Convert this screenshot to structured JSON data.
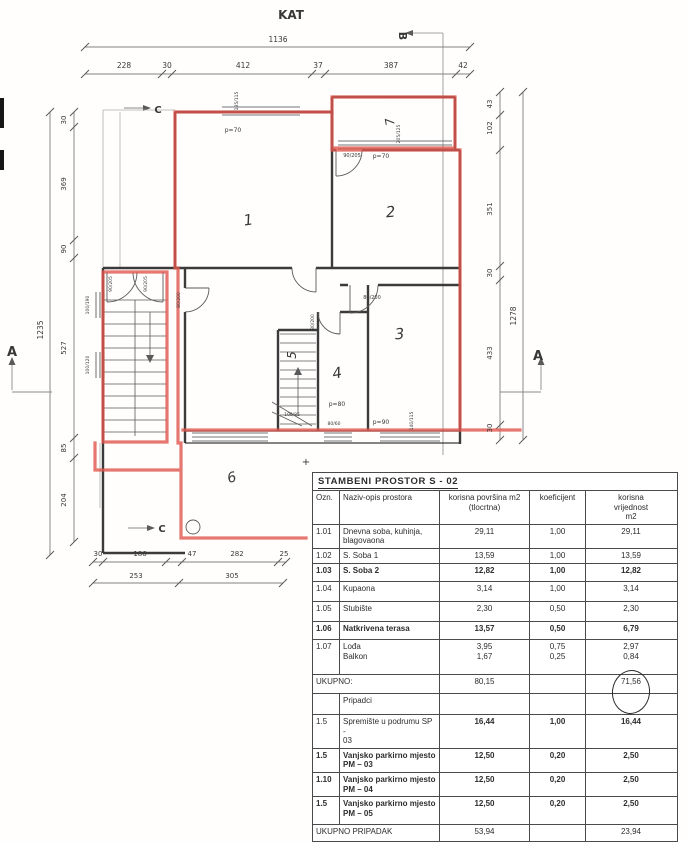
{
  "plan": {
    "ink": "#383838",
    "red": "#e0564e",
    "texts": [
      {
        "t": "KAT",
        "x": 291,
        "y": 19,
        "s": 12,
        "w": 1,
        "n": "plan-title"
      },
      {
        "t": "1136",
        "x": 278,
        "y": 42,
        "s": 7.5,
        "n": "dim-top-total"
      },
      {
        "t": "228",
        "x": 124,
        "y": 68,
        "s": 7.5,
        "n": "dim-top"
      },
      {
        "t": "30",
        "x": 167,
        "y": 68,
        "s": 7.5,
        "n": "dim-top"
      },
      {
        "t": "412",
        "x": 243,
        "y": 68,
        "s": 7.5,
        "n": "dim-top"
      },
      {
        "t": "37",
        "x": 318,
        "y": 68,
        "s": 7.5,
        "n": "dim-top"
      },
      {
        "t": "387",
        "x": 391,
        "y": 68,
        "s": 7.5,
        "n": "dim-top"
      },
      {
        "t": "42",
        "x": 463,
        "y": 68,
        "s": 7.5,
        "n": "dim-top"
      },
      {
        "t": "30",
        "x": 66,
        "y": 120,
        "s": 7,
        "r": -90,
        "n": "dim-left"
      },
      {
        "t": "369",
        "x": 66,
        "y": 184,
        "s": 7,
        "r": -90,
        "n": "dim-left"
      },
      {
        "t": "90",
        "x": 66,
        "y": 249,
        "s": 7,
        "r": -90,
        "n": "dim-left"
      },
      {
        "t": "527",
        "x": 66,
        "y": 348,
        "s": 7,
        "r": -90,
        "n": "dim-left"
      },
      {
        "t": "85",
        "x": 66,
        "y": 448,
        "s": 7,
        "r": -90,
        "n": "dim-left"
      },
      {
        "t": "204",
        "x": 66,
        "y": 500,
        "s": 7,
        "r": -90,
        "n": "dim-left"
      },
      {
        "t": "1235",
        "x": 43,
        "y": 330,
        "s": 7.5,
        "r": -90,
        "n": "dim-left-total"
      },
      {
        "t": "43",
        "x": 492,
        "y": 104,
        "s": 7,
        "r": -90,
        "n": "dim-right"
      },
      {
        "t": "102",
        "x": 492,
        "y": 128,
        "s": 7,
        "r": -90,
        "n": "dim-right"
      },
      {
        "t": "351",
        "x": 492,
        "y": 209,
        "s": 7,
        "r": -90,
        "n": "dim-right"
      },
      {
        "t": "30",
        "x": 492,
        "y": 273,
        "s": 7,
        "r": -90,
        "n": "dim-right"
      },
      {
        "t": "433",
        "x": 492,
        "y": 353,
        "s": 7,
        "r": -90,
        "n": "dim-right"
      },
      {
        "t": "30",
        "x": 492,
        "y": 428,
        "s": 7,
        "r": -90,
        "n": "dim-right"
      },
      {
        "t": "1278",
        "x": 516,
        "y": 316,
        "s": 7.5,
        "r": -90,
        "n": "dim-right-total"
      },
      {
        "t": "30",
        "x": 98,
        "y": 556,
        "s": 7,
        "n": "dim-bottom"
      },
      {
        "t": "186",
        "x": 140,
        "y": 556,
        "s": 7,
        "n": "dim-bottom"
      },
      {
        "t": "47",
        "x": 192,
        "y": 556,
        "s": 7,
        "n": "dim-bottom"
      },
      {
        "t": "282",
        "x": 237,
        "y": 556,
        "s": 7,
        "n": "dim-bottom"
      },
      {
        "t": "25",
        "x": 284,
        "y": 556,
        "s": 7,
        "n": "dim-bottom"
      },
      {
        "t": "253",
        "x": 136,
        "y": 578,
        "s": 7,
        "n": "dim-bottom"
      },
      {
        "t": "305",
        "x": 232,
        "y": 578,
        "s": 7,
        "n": "dim-bottom"
      },
      {
        "t": "A",
        "x": 12,
        "y": 356,
        "s": 13,
        "w": 1,
        "n": "section-mark-a-left"
      },
      {
        "t": "A",
        "x": 538,
        "y": 360,
        "s": 13,
        "w": 1,
        "n": "section-mark-a-right"
      },
      {
        "t": "B",
        "x": 399,
        "y": 36,
        "s": 11,
        "w": 1,
        "r": 90,
        "n": "section-mark-b"
      },
      {
        "t": "C",
        "x": 158,
        "y": 113,
        "s": 10,
        "w": 1,
        "n": "section-mark-c-top"
      },
      {
        "t": "C",
        "x": 162,
        "y": 532,
        "s": 10,
        "w": 1,
        "n": "section-mark-c-bottom"
      },
      {
        "t": "1",
        "x": 249,
        "y": 225,
        "s": 15,
        "i": 1,
        "r": -8,
        "n": "room-number-1"
      },
      {
        "t": "2",
        "x": 391,
        "y": 217,
        "s": 15,
        "i": 1,
        "r": -5,
        "n": "room-number-2"
      },
      {
        "t": "3",
        "x": 400,
        "y": 339,
        "s": 15,
        "i": 1,
        "r": -5,
        "n": "room-number-3"
      },
      {
        "t": "4",
        "x": 338,
        "y": 378,
        "s": 15,
        "i": 1,
        "r": -10,
        "n": "room-number-4"
      },
      {
        "t": "5",
        "x": 296,
        "y": 355,
        "s": 12,
        "i": 1,
        "r": -90,
        "n": "room-number-5"
      },
      {
        "t": "6",
        "x": 233,
        "y": 482,
        "s": 14,
        "i": 1,
        "r": -15,
        "n": "room-number-6"
      },
      {
        "t": "7",
        "x": 394,
        "y": 121,
        "s": 12,
        "i": 1,
        "r": -100,
        "n": "room-number-7"
      },
      {
        "t": "p=70",
        "x": 233,
        "y": 132,
        "s": 6,
        "n": "parapet-label"
      },
      {
        "t": "135/115",
        "x": 238,
        "y": 101,
        "s": 4.5,
        "r": -90,
        "n": "window-label"
      },
      {
        "t": "90/205",
        "x": 352,
        "y": 157,
        "s": 5,
        "n": "door-label"
      },
      {
        "t": "p=70",
        "x": 381,
        "y": 158,
        "s": 6,
        "n": "parapet-label"
      },
      {
        "t": "205/125",
        "x": 400,
        "y": 134,
        "s": 4.5,
        "r": -90,
        "n": "window-label"
      },
      {
        "t": "90/205",
        "x": 112,
        "y": 284,
        "s": 4.5,
        "r": -90,
        "n": "door-label"
      },
      {
        "t": "90/205",
        "x": 147,
        "y": 284,
        "s": 4.5,
        "r": -90,
        "n": "door-label"
      },
      {
        "t": "80/200",
        "x": 180,
        "y": 300,
        "s": 4.5,
        "r": -90,
        "n": "door-label"
      },
      {
        "t": "80/200",
        "x": 372,
        "y": 299,
        "s": 5,
        "n": "door-label"
      },
      {
        "t": "80/200",
        "x": 314,
        "y": 322,
        "s": 4.5,
        "r": -90,
        "n": "door-label"
      },
      {
        "t": "100/190",
        "x": 89,
        "y": 305,
        "s": 4.5,
        "r": -90,
        "n": "window-label"
      },
      {
        "t": "100/120",
        "x": 89,
        "y": 365,
        "s": 4.5,
        "r": -90,
        "n": "window-label"
      },
      {
        "t": "100/85",
        "x": 292,
        "y": 416,
        "s": 4.5,
        "n": "window-label"
      },
      {
        "t": "p=80",
        "x": 337,
        "y": 406,
        "s": 6,
        "n": "parapet-label"
      },
      {
        "t": "80/60",
        "x": 334,
        "y": 425,
        "s": 4.5,
        "n": "window-label"
      },
      {
        "t": "p=90",
        "x": 381,
        "y": 424,
        "s": 6,
        "n": "parapet-label"
      },
      {
        "t": "140/115",
        "x": 413,
        "y": 421,
        "s": 4.5,
        "r": -90,
        "n": "window-label"
      },
      {
        "t": "+",
        "x": 306,
        "y": 465,
        "s": 10,
        "n": "registration-cross"
      }
    ]
  },
  "table": {
    "title": "STAMBENI PROSTOR  S - 02",
    "headers": [
      "Ozn.",
      "Naziv-opis prostora",
      "korisna površina m2\n(tlocrtna)",
      "koeficijent",
      "korisna\nvrijednost\nm2"
    ],
    "rows": [
      {
        "ozn": "1.01",
        "name": "Dnevna soba, kuhinja,\nblagovaona",
        "p": "29,11",
        "k": "1,00",
        "v": "29,11"
      },
      {
        "ozn": "1.02",
        "name": "S. Soba 1",
        "p": "13,59",
        "k": "1,00",
        "v": "13,59"
      },
      {
        "ozn": "1.03",
        "name": "S. Soba 2",
        "p": "12,82",
        "k": "1,00",
        "v": "12,82",
        "bold": true
      },
      {
        "ozn": "1.04",
        "name": "Kupaona",
        "p": "3,14",
        "k": "1,00",
        "v": "3,14"
      },
      {
        "ozn": "1.05",
        "name": "Stubište",
        "p": "2,30",
        "k": "0,50",
        "v": "2,30"
      },
      {
        "ozn": "1.06",
        "name": "Natkrivena terasa",
        "p": "13,57",
        "k": "0,50",
        "v": "6,79",
        "bold": true
      },
      {
        "ozn": "1.07",
        "name": "Lođa\nBalkon",
        "p": "3,95\n1,67",
        "k": "0,75\n0,25",
        "v": "2,97\n0,84"
      },
      {
        "label": "UKUPNO:",
        "p": "80,15",
        "k": "",
        "v": "71,56",
        "span2": true,
        "circle": true
      },
      {
        "ozn": "",
        "name": "Pripadci",
        "p": "",
        "k": "",
        "v": ""
      },
      {
        "ozn": "1.5",
        "name": "Spremište u podrumu SP -\n03",
        "p": "16,44",
        "k": "1,00",
        "v": "16,44",
        "boldVals": true
      },
      {
        "ozn": "1.5",
        "name": "Vanjsko parkirno mjesto\nPM – 03",
        "p": "12,50",
        "k": "0,20",
        "v": "2,50",
        "bold": true
      },
      {
        "ozn": "1.10",
        "name": "Vanjsko parkirno mjesto\nPM – 04",
        "p": "12,50",
        "k": "0,20",
        "v": "2,50",
        "bold": true
      },
      {
        "ozn": "1.5",
        "name": "Vanjsko parkirno mjesto\nPM – 05",
        "p": "12,50",
        "k": "0,20",
        "v": "2,50",
        "bold": true
      },
      {
        "label": "UKUPNO PRIPADAK",
        "p": "53,94",
        "k": "",
        "v": "23,94",
        "span2": true
      },
      {
        "label": "SVEUKUPNO STAN S – 02 NA",
        "p": "134,09",
        "k": "",
        "v": "95,50",
        "span2": true
      }
    ]
  }
}
